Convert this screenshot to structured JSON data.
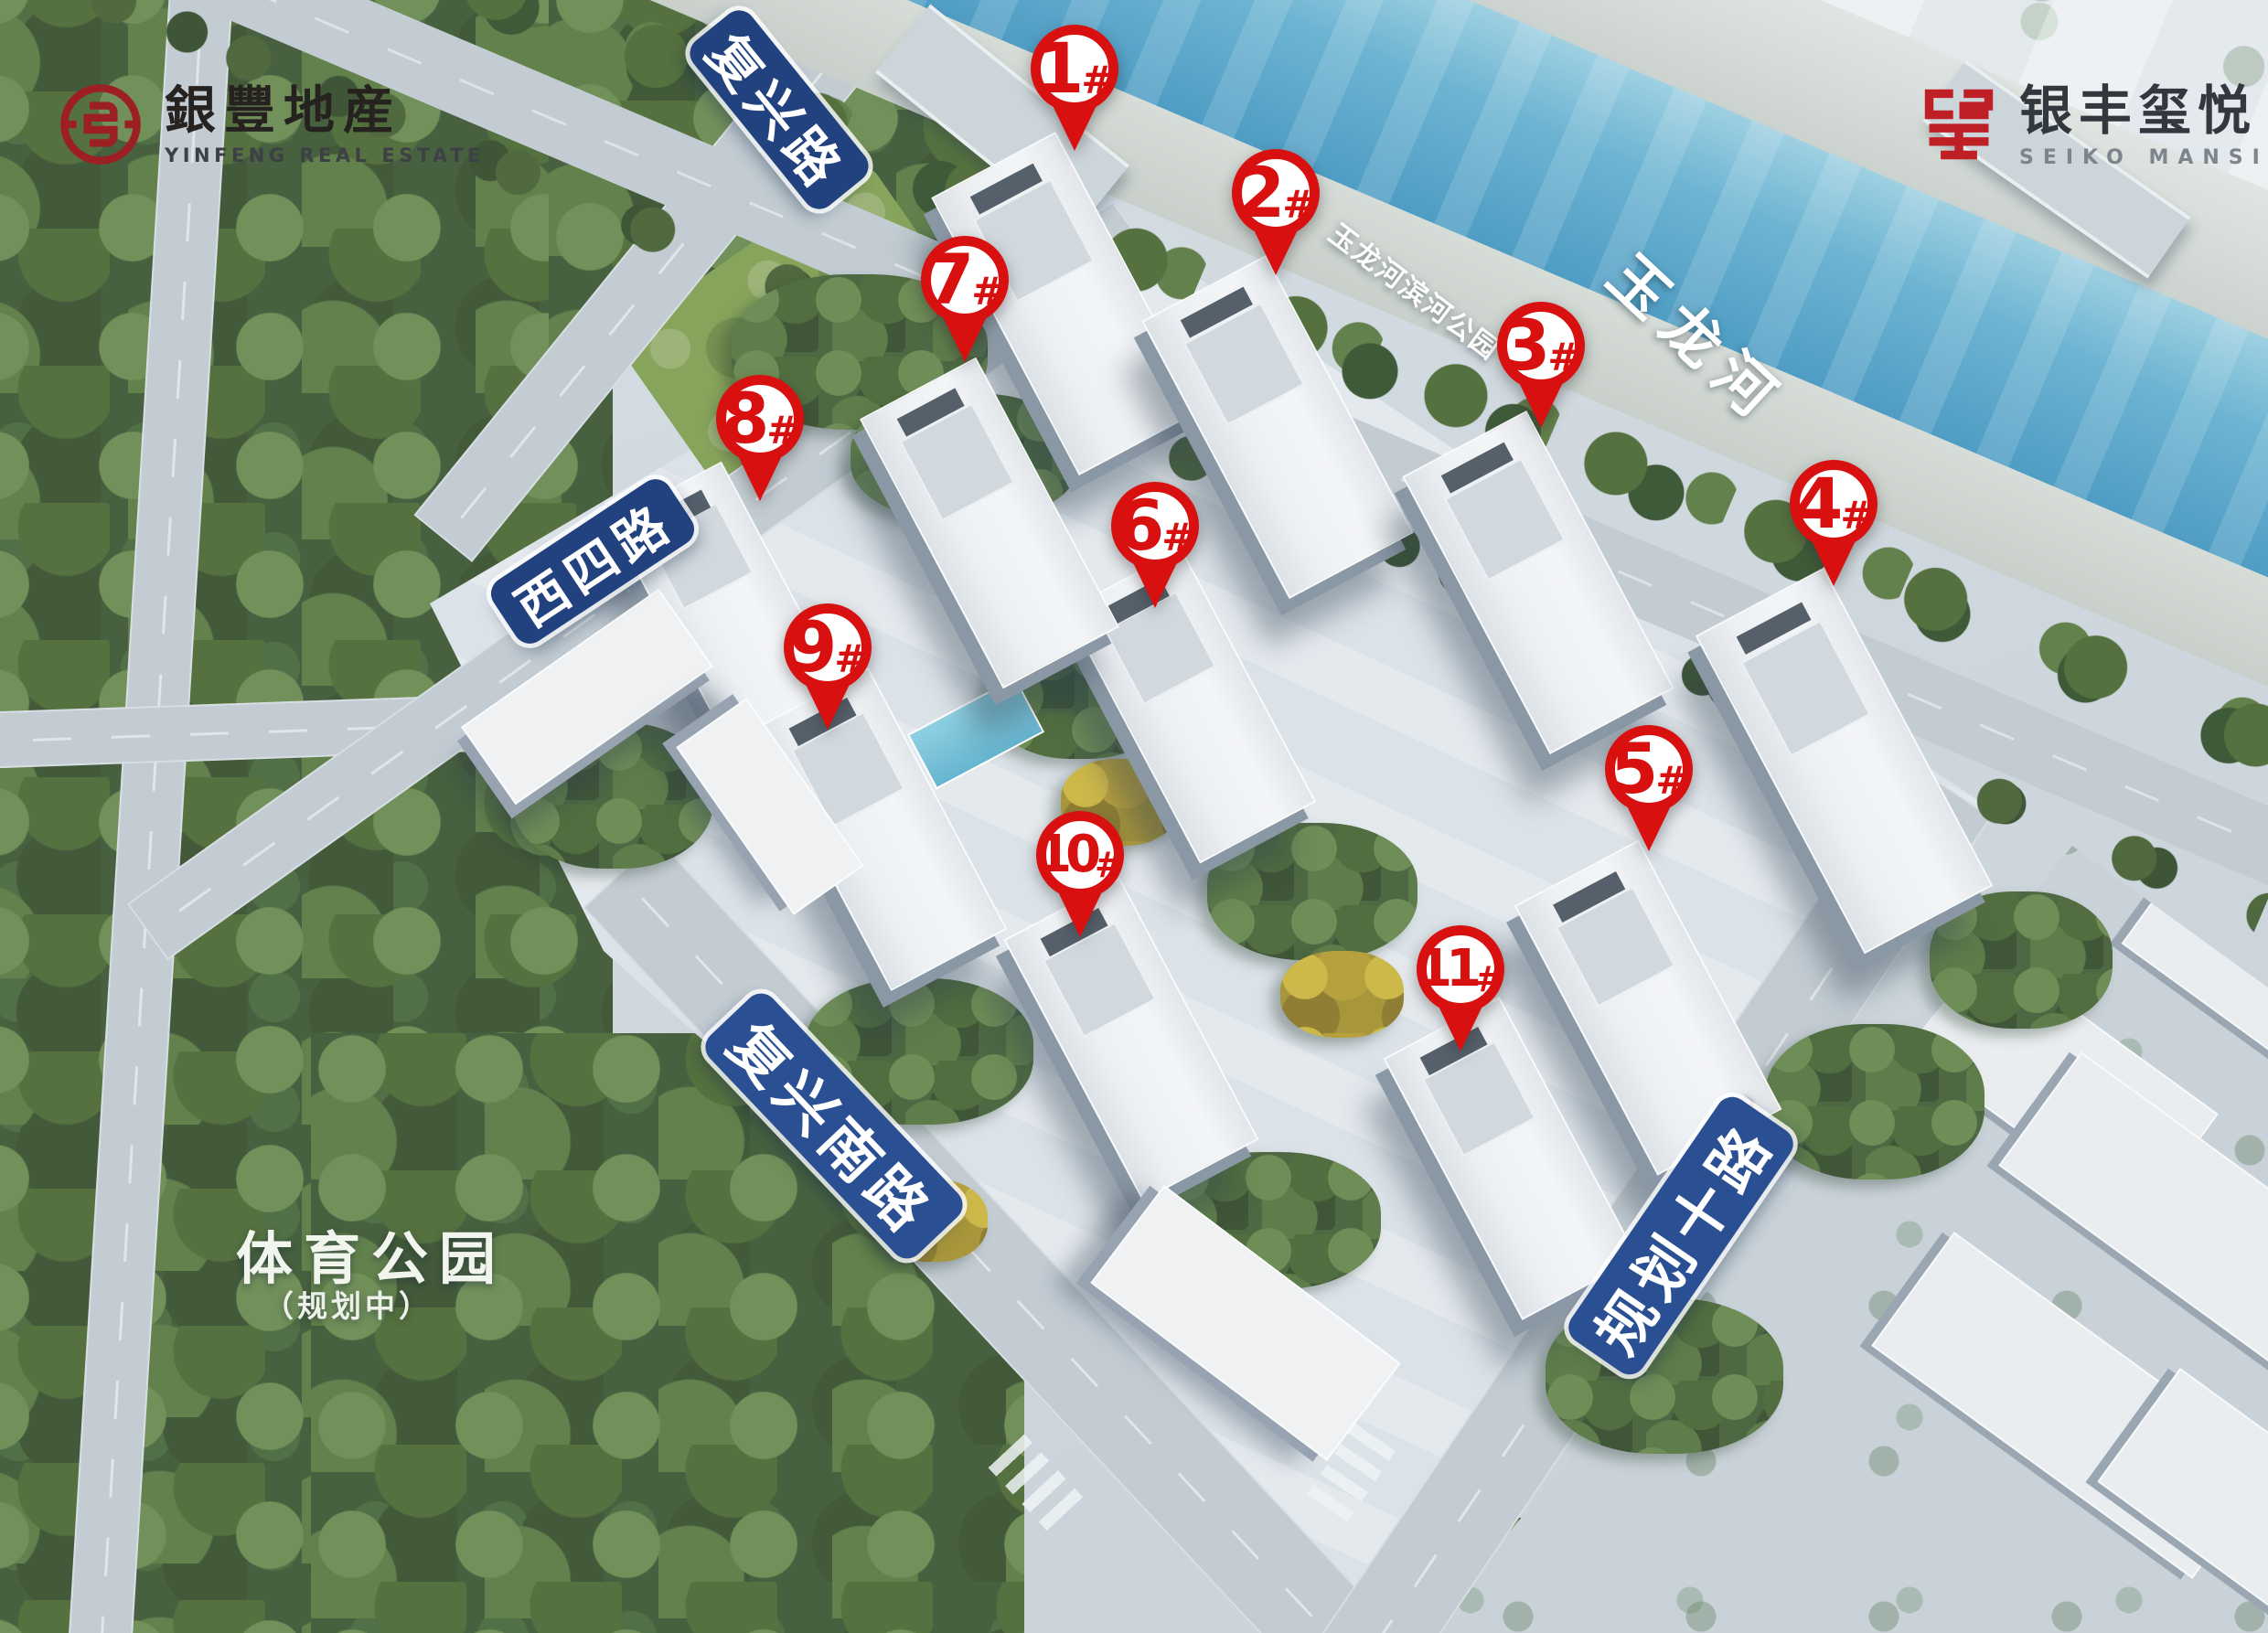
{
  "brand_left": {
    "name_cn": "銀豐地産",
    "name_en": "YINFENG REAL ESTATE"
  },
  "brand_right": {
    "name_cn": "银丰玺悦",
    "name_en": "SEIKO MANSION"
  },
  "water": {
    "river_name": "玉龙河",
    "riverside_park": "玉龙河滨河公园"
  },
  "parks": {
    "sports_park": "体育公园",
    "sports_park_status": "（规划中）"
  },
  "roads": {
    "fuxing": "复兴路",
    "xisi": "西四路",
    "fuxing_south": "复兴南路",
    "planned_10": "规划十路"
  },
  "markers": [
    {
      "number": "1",
      "suffix": "#"
    },
    {
      "number": "2",
      "suffix": "#"
    },
    {
      "number": "3",
      "suffix": "#"
    },
    {
      "number": "4",
      "suffix": "#"
    },
    {
      "number": "5",
      "suffix": "#"
    },
    {
      "number": "6",
      "suffix": "#"
    },
    {
      "number": "7",
      "suffix": "#"
    },
    {
      "number": "8",
      "suffix": "#"
    },
    {
      "number": "9",
      "suffix": "#"
    },
    {
      "number": "10",
      "suffix": "#"
    },
    {
      "number": "11",
      "suffix": "#"
    }
  ],
  "colors": {
    "marker_red": "#d8100f",
    "sign_blue": "#22427f",
    "brand_red": "#9c2023",
    "seal_red": "#bf2026"
  }
}
